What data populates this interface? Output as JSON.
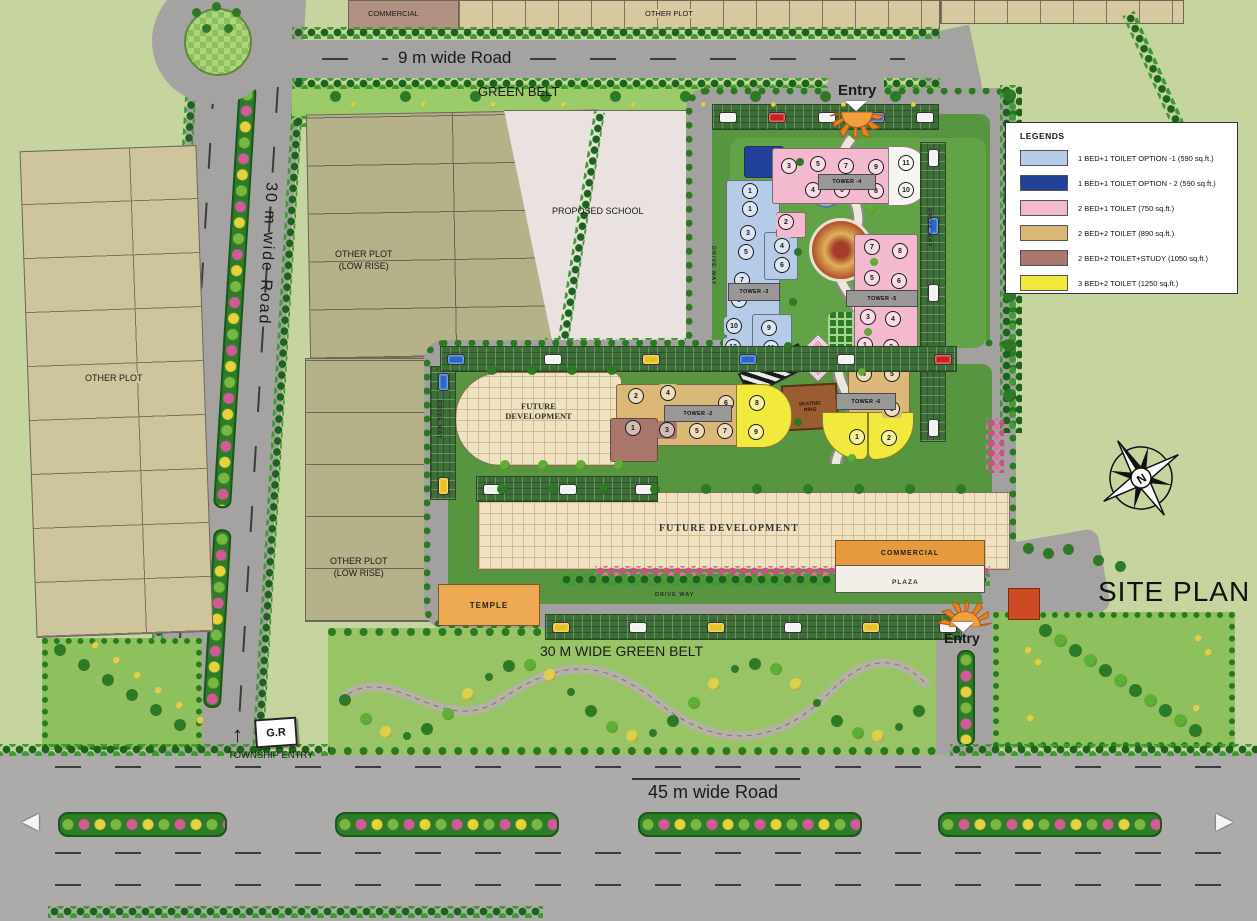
{
  "palette": {
    "lb": "#b6cbe7",
    "db": "#20409a",
    "pk": "#f3b9cf",
    "tn": "#dcb878",
    "br": "#a8766b",
    "yl": "#f1e93d",
    "wh": "#f6f4ee"
  },
  "colors": {
    "background": "#c6d5a0",
    "road": "#a5a3a1",
    "hedge_green": "#2a7a22",
    "belt_green": "#98c465",
    "dev_green": "#579540",
    "future_dev_beige": "#efe2c3",
    "commercial_orange": "#e89b3e",
    "temple_orange": "#edaa52",
    "school_gray": "#e9e2e1",
    "plot_tan": "#d6c9a0",
    "plot_olive": "#b5b189"
  },
  "labels": {
    "commercial_top": "COMMERCIAL",
    "other_plot_top": "OTHER PLOT",
    "other_plot_left": "OTHER PLOT",
    "low_rise_1": "OTHER PLOT",
    "low_rise_2": "(LOW RISE)",
    "school": "PROPOSED SCHOOL",
    "green_belt": "GREEN BELT",
    "road_9m": "9 m wide  Road",
    "road_30m": "30 m wide  Road",
    "road_45m": "45 m wide  Road",
    "green_belt_30m": "30 M WIDE GREEN BELT",
    "drive_way": "DRIVE WAY",
    "future_dev": "FUTURE DEVELOPMENT",
    "future_dev_l1": "FUTURE",
    "future_dev_l2": "DEVELOPMENT",
    "commercial": "COMMERCIAL",
    "plaza": "PLAZA",
    "temple": "TEMPLE",
    "skating_1": "SKATING",
    "skating_2": "RING",
    "entry": "Entry",
    "township_entry": "TOWNSHIP ENTRY",
    "gr_sign": "G.R",
    "site_plan": "SITE PLAN",
    "north": "N"
  },
  "legend": {
    "title": "LEGENDS",
    "entries": [
      {
        "color": "#b6cbe7",
        "label": "1 BED+1 TOILET OPTION -1   (590 sq.ft.)"
      },
      {
        "color": "#20409a",
        "label": "1 BED+1 TOILET OPTION - 2  (590 sq.ft.)"
      },
      {
        "color": "#f3b9cf",
        "label": "2 BED+1 TOILET   (750 sq.ft.)"
      },
      {
        "color": "#dcb878",
        "label": "2 BED+2 TOILET  (890 sq.ft.)"
      },
      {
        "color": "#a8766b",
        "label": "2 BED+2 TOILET+STUDY   (1050 sq.ft.)"
      },
      {
        "color": "#f1e93d",
        "label": "3 BED+2 TOILET  (1250 sq.ft.)"
      }
    ]
  },
  "towers": [
    {
      "name": "TOWER -3",
      "label": {
        "x": 728,
        "y": 283,
        "w": 50,
        "h": 16
      },
      "blocks": [
        {
          "x": 744,
          "y": 146,
          "w": 38,
          "h": 30,
          "c": "db"
        },
        {
          "x": 726,
          "y": 180,
          "w": 52,
          "h": 180,
          "c": "lb"
        },
        {
          "x": 764,
          "y": 232,
          "w": 32,
          "h": 46,
          "c": "lb"
        },
        {
          "x": 752,
          "y": 314,
          "w": 38,
          "h": 48,
          "c": "lb"
        },
        {
          "x": 776,
          "y": 212,
          "w": 28,
          "h": 24,
          "c": "pk"
        }
      ],
      "units": [
        {
          "n": "1",
          "x": 750,
          "y": 191,
          "c": "lb"
        },
        {
          "n": "1",
          "x": 750,
          "y": 209,
          "c": "lb"
        },
        {
          "n": "3",
          "x": 748,
          "y": 233,
          "c": "lb"
        },
        {
          "n": "5",
          "x": 746,
          "y": 252,
          "c": "lb"
        },
        {
          "n": "7",
          "x": 742,
          "y": 280,
          "c": "lb"
        },
        {
          "n": "8",
          "x": 739,
          "y": 300,
          "c": "lb"
        },
        {
          "n": "10",
          "x": 734,
          "y": 326,
          "c": "lb"
        },
        {
          "n": "12",
          "x": 733,
          "y": 347,
          "c": "lb"
        },
        {
          "n": "2",
          "x": 786,
          "y": 222,
          "c": "pk"
        },
        {
          "n": "4",
          "x": 782,
          "y": 246,
          "c": "lb"
        },
        {
          "n": "6",
          "x": 782,
          "y": 265,
          "c": "lb"
        },
        {
          "n": "9",
          "x": 769,
          "y": 328,
          "c": "lb"
        },
        {
          "n": "11",
          "x": 771,
          "y": 348,
          "c": "lb"
        }
      ]
    },
    {
      "name": "TOWER -4",
      "label": {
        "x": 818,
        "y": 174,
        "w": 56,
        "h": 14
      },
      "blocks": [
        {
          "x": 772,
          "y": 148,
          "w": 120,
          "h": 54,
          "c": "pk"
        },
        {
          "x": 888,
          "y": 146,
          "w": 40,
          "h": 58,
          "c": "wh",
          "r": "0 28px 28px 0"
        }
      ],
      "units": [
        {
          "n": "3",
          "x": 789,
          "y": 166,
          "c": "pk"
        },
        {
          "n": "5",
          "x": 818,
          "y": 164,
          "c": "pk"
        },
        {
          "n": "7",
          "x": 846,
          "y": 166,
          "c": "pk"
        },
        {
          "n": "9",
          "x": 876,
          "y": 167,
          "c": "pk"
        },
        {
          "n": "11",
          "x": 906,
          "y": 163,
          "c": "wh"
        },
        {
          "n": "4",
          "x": 813,
          "y": 190,
          "c": "pk"
        },
        {
          "n": "6",
          "x": 842,
          "y": 190,
          "c": "pk"
        },
        {
          "n": "8",
          "x": 876,
          "y": 191,
          "c": "pk"
        },
        {
          "n": "10",
          "x": 906,
          "y": 190,
          "c": "wh"
        }
      ]
    },
    {
      "name": "TOWER -5",
      "label": {
        "x": 846,
        "y": 290,
        "w": 70,
        "h": 15
      },
      "blocks": [
        {
          "x": 854,
          "y": 234,
          "w": 62,
          "h": 126,
          "c": "pk"
        }
      ],
      "units": [
        {
          "n": "7",
          "x": 872,
          "y": 247,
          "c": "pk"
        },
        {
          "n": "8",
          "x": 900,
          "y": 251,
          "c": "pk"
        },
        {
          "n": "5",
          "x": 872,
          "y": 278,
          "c": "pk"
        },
        {
          "n": "6",
          "x": 899,
          "y": 281,
          "c": "pk"
        },
        {
          "n": "3",
          "x": 868,
          "y": 317,
          "c": "pk"
        },
        {
          "n": "4",
          "x": 893,
          "y": 319,
          "c": "pk"
        },
        {
          "n": "1",
          "x": 865,
          "y": 345,
          "c": "pk"
        },
        {
          "n": "2",
          "x": 891,
          "y": 347,
          "c": "pk"
        }
      ]
    },
    {
      "name": "TOWER -6",
      "label": {
        "x": 836,
        "y": 393,
        "w": 58,
        "h": 15
      },
      "blocks": [
        {
          "x": 848,
          "y": 362,
          "w": 60,
          "h": 60,
          "c": "tn"
        },
        {
          "x": 822,
          "y": 412,
          "w": 44,
          "h": 46,
          "c": "yl",
          "r": "0 0 8px 44px"
        },
        {
          "x": 868,
          "y": 412,
          "w": 44,
          "h": 46,
          "c": "yl",
          "r": "0 0 44px 8px"
        }
      ],
      "units": [
        {
          "n": "4",
          "x": 864,
          "y": 374,
          "c": "tn"
        },
        {
          "n": "5",
          "x": 892,
          "y": 374,
          "c": "tn"
        },
        {
          "n": "3",
          "x": 892,
          "y": 409,
          "c": "tn"
        },
        {
          "n": "1",
          "x": 857,
          "y": 437,
          "c": "yl"
        },
        {
          "n": "2",
          "x": 889,
          "y": 438,
          "c": "yl"
        }
      ]
    },
    {
      "name": "TOWER -2",
      "label": {
        "x": 664,
        "y": 405,
        "w": 66,
        "h": 15
      },
      "blocks": [
        {
          "x": 616,
          "y": 384,
          "w": 122,
          "h": 60,
          "c": "tn"
        },
        {
          "x": 610,
          "y": 418,
          "w": 46,
          "h": 42,
          "c": "br"
        },
        {
          "x": 736,
          "y": 384,
          "w": 54,
          "h": 62,
          "c": "yl",
          "r": "0 30px 30px 0"
        }
      ],
      "units": [
        {
          "n": "2",
          "x": 636,
          "y": 396,
          "c": "tn"
        },
        {
          "n": "4",
          "x": 668,
          "y": 393,
          "c": "tn"
        },
        {
          "n": "6",
          "x": 726,
          "y": 403,
          "c": "tn"
        },
        {
          "n": "1",
          "x": 633,
          "y": 428,
          "c": "br"
        },
        {
          "n": "3",
          "x": 667,
          "y": 430,
          "c": "br"
        },
        {
          "n": "5",
          "x": 697,
          "y": 431,
          "c": "tn"
        },
        {
          "n": "7",
          "x": 725,
          "y": 431,
          "c": "tn"
        },
        {
          "n": "8",
          "x": 757,
          "y": 403,
          "c": "yl"
        },
        {
          "n": "9",
          "x": 756,
          "y": 432,
          "c": "yl"
        }
      ]
    }
  ],
  "parking": {
    "strips": [
      {
        "x": 712,
        "y": 104,
        "w": 225,
        "h": 24,
        "dir": "h",
        "cars": [
          "#f2f2f0",
          "#cc2020",
          "#f2f2f0",
          "#2868c8",
          "#f2f2f0"
        ]
      },
      {
        "x": 920,
        "y": 142,
        "w": 24,
        "h": 298,
        "dir": "v",
        "cars": [
          "#f2f2f0",
          "#2868c8",
          "#f2f2f0",
          "#e8c020",
          "#f2f2f0"
        ]
      },
      {
        "x": 430,
        "y": 366,
        "w": 24,
        "h": 132,
        "dir": "v",
        "cars": [
          "#2868c8",
          "#e8c020"
        ]
      },
      {
        "x": 476,
        "y": 476,
        "w": 180,
        "h": 24,
        "dir": "h",
        "cars": [
          "#f2f2f0",
          "#f2f2f0",
          "#f2f2f0"
        ]
      },
      {
        "x": 440,
        "y": 346,
        "w": 515,
        "h": 24,
        "dir": "h",
        "cars": [
          "#2868c8",
          "#f2f2f0",
          "#e8c020",
          "#2868c8",
          "#f2f2f0",
          "#cc2020"
        ]
      },
      {
        "x": 545,
        "y": 614,
        "w": 415,
        "h": 24,
        "dir": "h",
        "cars": [
          "#e8c020",
          "#f2f2f0",
          "#e8c020",
          "#f2f2f0",
          "#e8c020",
          "#f2f2f0"
        ]
      }
    ]
  },
  "driveway": {
    "spots": [
      [
        710,
        246,
        1
      ],
      [
        436,
        400,
        1
      ],
      [
        926,
        208,
        1
      ],
      [
        655,
        592,
        0
      ]
    ]
  }
}
